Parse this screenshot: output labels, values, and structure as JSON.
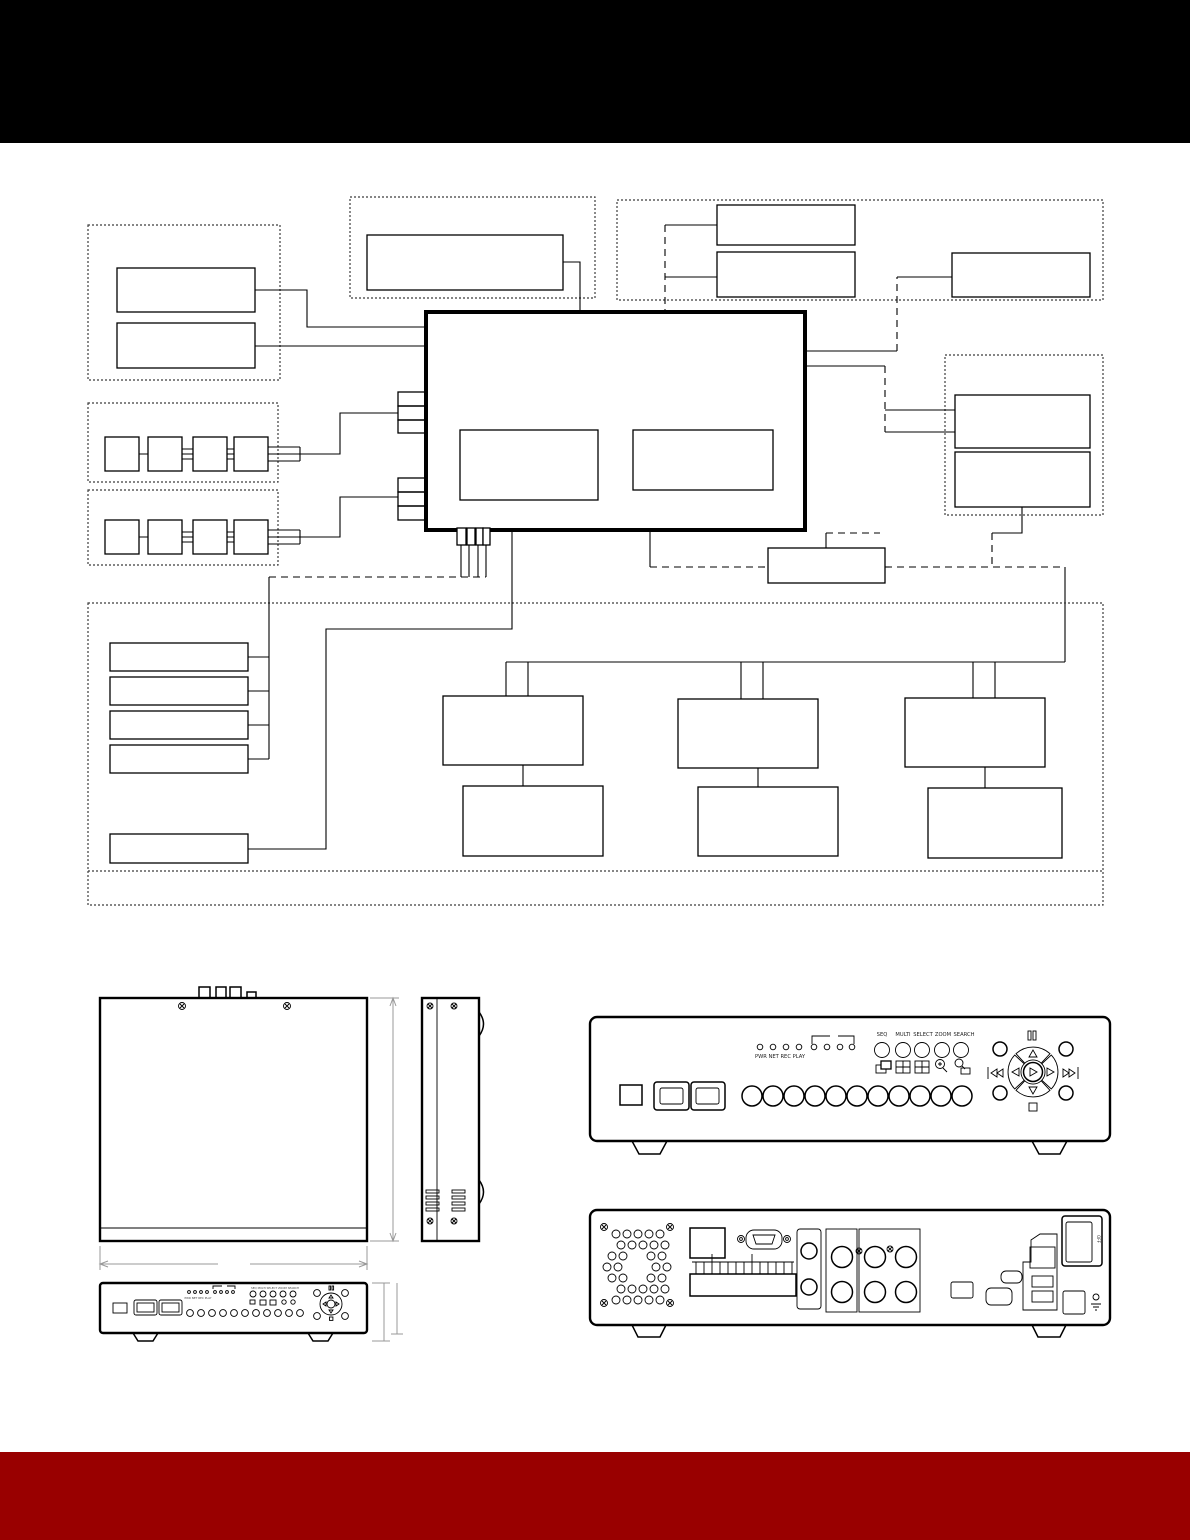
{
  "page": {
    "background": "#ffffff",
    "header_color": "#000000",
    "footer_color": "#990000"
  },
  "front_panel": {
    "led_caption": "PWR NET REC PLAY",
    "mode_buttons": [
      "SEQ",
      "MULTI",
      "SELECT",
      "ZOOM",
      "SEARCH"
    ]
  },
  "back_panel": {
    "power_switch_label": "OFF"
  },
  "small_front_panel": {
    "led_caption": "PWR NET REC PLAY",
    "mode_caption": "SEQ MULTI SELECT ZOOM SEARCH"
  }
}
